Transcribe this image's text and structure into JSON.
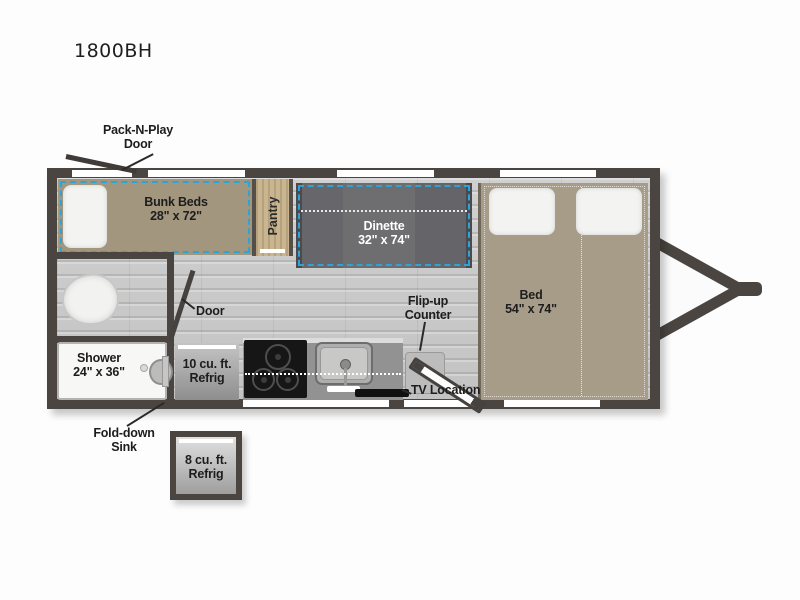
{
  "title": "1800BH",
  "colors": {
    "wall": "#4a4541",
    "dash_accent": "#2ea3d6",
    "bed_tan": "#a79c87",
    "bunk_tan": "#a2967f",
    "dinette_gray": "#646467",
    "floor_gray": "#c9c9c9",
    "pantry_wood": "#c9b58f"
  },
  "areas": {
    "bunk": {
      "name": "Bunk Beds",
      "size": "28\" x 72\""
    },
    "pantry": {
      "name": "Pantry"
    },
    "dinette": {
      "name": "Dinette",
      "size": "32\" x 74\""
    },
    "bed": {
      "name": "Bed",
      "size": "54\" x 74\""
    },
    "shower": {
      "name": "Shower",
      "size": "24\" x 36\""
    },
    "refrig_10": {
      "line1": "10 cu. ft.",
      "line2": "Refrig"
    },
    "refrig_8": {
      "line1": "8 cu. ft.",
      "line2": "Refrig"
    }
  },
  "callouts": {
    "pack_n_play": {
      "line1": "Pack-N-Play",
      "line2": "Door"
    },
    "interior_door": {
      "label": "Door"
    },
    "flip_up_counter": {
      "line1": "Flip-up",
      "line2": "Counter"
    },
    "tv_location": {
      "label": "TV Location"
    },
    "fold_down_sink": {
      "line1": "Fold-down",
      "line2": "Sink"
    }
  }
}
